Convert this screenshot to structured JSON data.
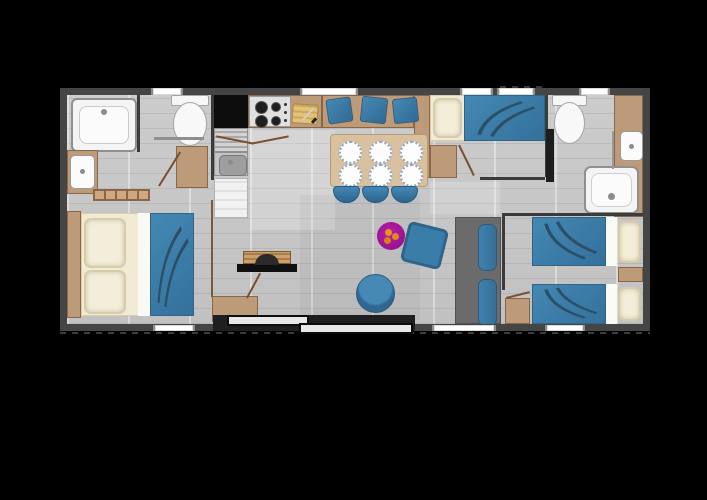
{
  "scene": {
    "kind": "floor-plan",
    "subject": "mobile-home-holiday-lodge",
    "orientation": "landscape"
  },
  "canvas": {
    "width": 707,
    "height": 500,
    "background": "#000000"
  },
  "palette": {
    "outer_wall": "#454545",
    "inner_wall": "#3b3b3b",
    "floor": "#c7c7c7",
    "wood": "#bd9a78",
    "wood_dark": "#8a6648",
    "wood_table": "#d9c09f",
    "blue": "#3a7da8",
    "blue_dark": "#2e6488",
    "duvet_stroke": "#2b4f66",
    "magenta_rug": "#a8109e",
    "orange": "#e5941f",
    "cream": "#f1ead4",
    "white_fixture": "#f6f6f6",
    "steel": "#bfbfbf",
    "black_counter": "#0d0d0d",
    "gray_sofa": "#6b6b6b",
    "window": "#ffffff",
    "door_wood": "#7b4f2e"
  },
  "rooms": [
    "master-bedroom",
    "en-suite-corner",
    "kitchen",
    "dining-area",
    "living-area",
    "second-bedroom",
    "shower-room",
    "twin-bedroom",
    "hallway"
  ],
  "counts": {
    "dining_plates": 6,
    "dining_stools": 3,
    "bench_pillows": 3,
    "double_beds": 1,
    "single_beds": 3,
    "toilets": 2,
    "wash_basins": 3,
    "windows_top": 5,
    "windows_bottom": 3
  },
  "names": {
    "bathtub": "Bathtub",
    "master_basin": "Wash basin",
    "master_toilet": "Toilet",
    "master_bed": "Double bed",
    "master_cabinet": "Cabinet",
    "wall_shelf": "Wall shelf",
    "hob": "Hob",
    "sink": "Kitchen sink and drainer",
    "fridge": "Fridge",
    "chopping_board": "Chopping board",
    "bench_sofa": "Bench sofa with cushions",
    "dining_table": "Dining table with six plates",
    "stool": "Stool",
    "tall_cupboard": "Tall cupboard",
    "tv_unit": "TV unit",
    "storage_cabinet": "Storage cabinet",
    "rug": "Round rug",
    "floor_cushion": "Floor cushion",
    "pouf": "Round pouf",
    "gray_sofa": "Sofa unit",
    "patio_door": "Sliding patio door",
    "bed2": "Single bed",
    "wardrobe2": "Wardrobe",
    "toilet2": "Toilet",
    "basin2": "Wash basin",
    "shower": "Shower",
    "twin_bed": "Single bed",
    "nightstand": "Bedside cabinet",
    "window": "Window"
  }
}
